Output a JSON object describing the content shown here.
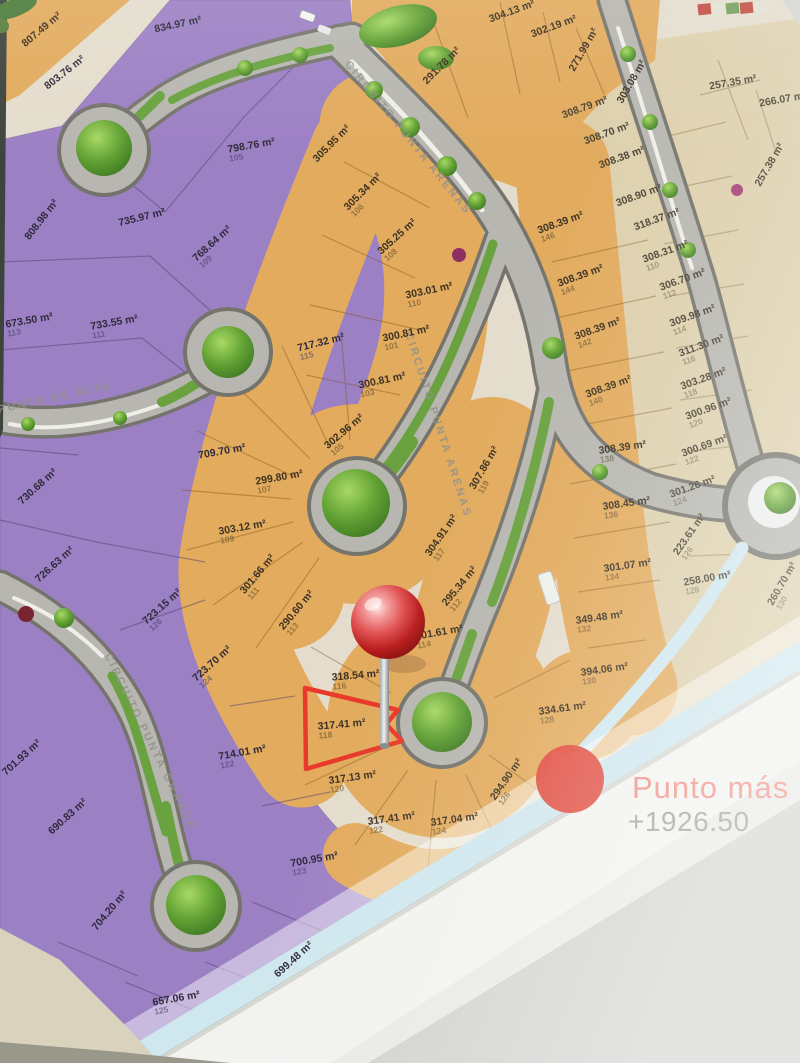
{
  "annotation": {
    "label_partial": "Punto más b",
    "elevation": "+1926.50"
  },
  "highlight": {
    "area": "317.41 m²",
    "lot": "118"
  },
  "colors": {
    "purple_zone": "#9c80c4",
    "orange_zone": "#e2ab5e",
    "beige_zone": "#ddd0ad",
    "road_fill": "#b7b6b0",
    "road_casing": "#75746c",
    "highlight_red": "#e8392a",
    "pin_red": "#c21f1f",
    "edge_blue": "#cfe7ee",
    "punto_text": "#ef8d82",
    "elevation_text": "#9fa09b",
    "tree_green": "#63a335"
  },
  "streets": [
    {
      "name": "CIRCUITO PUNTA ARENAS",
      "x": 408,
      "y": 138,
      "rot": 51
    },
    {
      "name": "CIRCUITO PUNTA ARENAS",
      "x": 438,
      "y": 425,
      "rot": 72
    },
    {
      "name": "PUNTA DE MITA",
      "x": 55,
      "y": 398,
      "rot": -12
    },
    {
      "name": "CIRCUITO PUNTA GRANDE",
      "x": 150,
      "y": 742,
      "rot": 64
    }
  ],
  "lots": [
    {
      "zone": "purple",
      "area": "834.97 m²",
      "lot": "",
      "x": 178,
      "y": 25,
      "rot": -12
    },
    {
      "zone": "purple",
      "area": "803.76 m²",
      "lot": "",
      "x": 65,
      "y": 73,
      "rot": -38
    },
    {
      "zone": "purple",
      "area": "798.76 m²",
      "lot": "105",
      "x": 252,
      "y": 150,
      "rot": -10
    },
    {
      "zone": "purple",
      "area": "808.98 m²",
      "lot": "",
      "x": 42,
      "y": 220,
      "rot": -52
    },
    {
      "zone": "purple",
      "area": "735.97 m²",
      "lot": "",
      "x": 142,
      "y": 218,
      "rot": -14
    },
    {
      "zone": "purple",
      "area": "768.64 m²",
      "lot": "109",
      "x": 215,
      "y": 247,
      "rot": -42
    },
    {
      "zone": "purple",
      "area": "733.55 m²",
      "lot": "111",
      "x": 115,
      "y": 327,
      "rot": -10
    },
    {
      "zone": "purple",
      "area": "673.50 m²",
      "lot": "113",
      "x": 30,
      "y": 325,
      "rot": -10
    },
    {
      "zone": "purple",
      "area": "717.32 m²",
      "lot": "115",
      "x": 322,
      "y": 347,
      "rot": -14
    },
    {
      "zone": "purple",
      "area": "709.70 m²",
      "lot": "",
      "x": 222,
      "y": 452,
      "rot": -10
    },
    {
      "zone": "purple",
      "area": "730.68 m²",
      "lot": "",
      "x": 38,
      "y": 487,
      "rot": -42
    },
    {
      "zone": "purple",
      "area": "726.63 m²",
      "lot": "",
      "x": 55,
      "y": 565,
      "rot": -42
    },
    {
      "zone": "purple",
      "area": "723.15 m²",
      "lot": "126",
      "x": 165,
      "y": 610,
      "rot": -42
    },
    {
      "zone": "purple",
      "area": "723.70 m²",
      "lot": "124",
      "x": 215,
      "y": 667,
      "rot": -42
    },
    {
      "zone": "purple",
      "area": "714.01 m²",
      "lot": "122",
      "x": 243,
      "y": 757,
      "rot": -10
    },
    {
      "zone": "purple",
      "area": "701.93 m²",
      "lot": "",
      "x": 22,
      "y": 758,
      "rot": -42
    },
    {
      "zone": "purple",
      "area": "690.83 m²",
      "lot": "",
      "x": 68,
      "y": 817,
      "rot": -42
    },
    {
      "zone": "purple",
      "area": "700.95 m²",
      "lot": "123",
      "x": 315,
      "y": 864,
      "rot": -10
    },
    {
      "zone": "purple",
      "area": "704.20 m²",
      "lot": "",
      "x": 110,
      "y": 911,
      "rot": -50
    },
    {
      "zone": "purple",
      "area": "699.48 m²",
      "lot": "",
      "x": 294,
      "y": 960,
      "rot": -42
    },
    {
      "zone": "purple",
      "area": "657.06 m²",
      "lot": "125",
      "x": 177,
      "y": 1003,
      "rot": -10
    },
    {
      "zone": "orange",
      "area": "807.49 m²",
      "lot": "",
      "x": 42,
      "y": 30,
      "rot": -40
    },
    {
      "zone": "orange",
      "area": "305.95 m²",
      "lot": "",
      "x": 332,
      "y": 144,
      "rot": -45
    },
    {
      "zone": "orange",
      "area": "291.78 m²",
      "lot": "",
      "x": 442,
      "y": 66,
      "rot": -45
    },
    {
      "zone": "orange",
      "area": "304.13 m²",
      "lot": "",
      "x": 512,
      "y": 12,
      "rot": -20
    },
    {
      "zone": "orange",
      "area": "302.19 m²",
      "lot": "",
      "x": 554,
      "y": 27,
      "rot": -20
    },
    {
      "zone": "orange",
      "area": "271.99 m²",
      "lot": "",
      "x": 584,
      "y": 50,
      "rot": -60
    },
    {
      "zone": "orange",
      "area": "303.08 m²",
      "lot": "",
      "x": 632,
      "y": 82,
      "rot": -60
    },
    {
      "zone": "orange",
      "area": "305.34 m²",
      "lot": "106",
      "x": 366,
      "y": 195,
      "rot": -45
    },
    {
      "zone": "orange",
      "area": "305.25 m²",
      "lot": "108",
      "x": 400,
      "y": 240,
      "rot": -42
    },
    {
      "zone": "orange",
      "area": "303.01 m²",
      "lot": "110",
      "x": 430,
      "y": 295,
      "rot": -12
    },
    {
      "zone": "orange",
      "area": "300.81 m²",
      "lot": "101",
      "x": 407,
      "y": 338,
      "rot": -12
    },
    {
      "zone": "orange",
      "area": "300.81 m²",
      "lot": "103",
      "x": 383,
      "y": 385,
      "rot": -12
    },
    {
      "zone": "orange",
      "area": "302.96 m²",
      "lot": "105",
      "x": 347,
      "y": 435,
      "rot": -40
    },
    {
      "zone": "orange",
      "area": "299.80 m²",
      "lot": "107",
      "x": 280,
      "y": 482,
      "rot": -10
    },
    {
      "zone": "orange",
      "area": "303.12 m²",
      "lot": "109",
      "x": 243,
      "y": 532,
      "rot": -10
    },
    {
      "zone": "orange",
      "area": "301.66 m²",
      "lot": "111",
      "x": 261,
      "y": 577,
      "rot": -50
    },
    {
      "zone": "orange",
      "area": "290.60 m²",
      "lot": "113",
      "x": 300,
      "y": 613,
      "rot": -50
    },
    {
      "zone": "orange",
      "area": "307.86 m²",
      "lot": "119",
      "x": 488,
      "y": 470,
      "rot": -60
    },
    {
      "zone": "orange",
      "area": "304.91 m²",
      "lot": "117",
      "x": 445,
      "y": 538,
      "rot": -55
    },
    {
      "zone": "orange",
      "area": "295.34 m²",
      "lot": "112",
      "x": 463,
      "y": 589,
      "rot": -50
    },
    {
      "zone": "orange",
      "area": "301.61 m²",
      "lot": "114",
      "x": 440,
      "y": 637,
      "rot": -10
    },
    {
      "zone": "orange",
      "area": "318.54 m²",
      "lot": "116",
      "x": 356,
      "y": 680,
      "rot": -5
    },
    {
      "zone": "orange",
      "area": "317.41 m²",
      "lot": "118",
      "x": 342,
      "y": 729,
      "rot": -5,
      "hl": true
    },
    {
      "zone": "orange",
      "area": "317.13 m²",
      "lot": "120",
      "x": 353,
      "y": 782,
      "rot": -8
    },
    {
      "zone": "orange",
      "area": "317.41 m²",
      "lot": "122",
      "x": 392,
      "y": 823,
      "rot": -8
    },
    {
      "zone": "orange",
      "area": "317.04 m²",
      "lot": "124",
      "x": 455,
      "y": 824,
      "rot": -8
    },
    {
      "zone": "orange",
      "area": "294.90 m²",
      "lot": "126",
      "x": 510,
      "y": 782,
      "rot": -55
    },
    {
      "zone": "orange",
      "area": "334.61 m²",
      "lot": "128",
      "x": 563,
      "y": 713,
      "rot": -8
    },
    {
      "zone": "orange",
      "area": "394.06 m²",
      "lot": "130",
      "x": 605,
      "y": 674,
      "rot": -8
    },
    {
      "zone": "orange",
      "area": "349.48 m²",
      "lot": "132",
      "x": 600,
      "y": 622,
      "rot": -8
    },
    {
      "zone": "orange",
      "area": "301.07 m²",
      "lot": "134",
      "x": 628,
      "y": 570,
      "rot": -8
    },
    {
      "zone": "orange",
      "area": "308.45 m²",
      "lot": "136",
      "x": 627,
      "y": 508,
      "rot": -8
    },
    {
      "zone": "orange",
      "area": "308.39 m²",
      "lot": "138",
      "x": 623,
      "y": 452,
      "rot": -8
    },
    {
      "zone": "orange",
      "area": "308.39 m²",
      "lot": "140",
      "x": 610,
      "y": 391,
      "rot": -20
    },
    {
      "zone": "orange",
      "area": "308.39 m²",
      "lot": "142",
      "x": 599,
      "y": 333,
      "rot": -20
    },
    {
      "zone": "orange",
      "area": "308.39 m²",
      "lot": "144",
      "x": 582,
      "y": 280,
      "rot": -20
    },
    {
      "zone": "orange",
      "area": "308.39 m²",
      "lot": "146",
      "x": 562,
      "y": 227,
      "rot": -20
    },
    {
      "zone": "beige",
      "area": "257.35 m²",
      "lot": "",
      "x": 733,
      "y": 83,
      "rot": -10
    },
    {
      "zone": "beige",
      "area": "266.07 m²",
      "lot": "",
      "x": 783,
      "y": 100,
      "rot": -10
    },
    {
      "zone": "beige",
      "area": "257.38 m²",
      "lot": "",
      "x": 770,
      "y": 165,
      "rot": -60
    },
    {
      "zone": "beige",
      "area": "308.79 m²",
      "lot": "",
      "x": 585,
      "y": 108,
      "rot": -20
    },
    {
      "zone": "beige",
      "area": "308.70 m²",
      "lot": "",
      "x": 607,
      "y": 134,
      "rot": -20
    },
    {
      "zone": "beige",
      "area": "308.38 m²",
      "lot": "",
      "x": 622,
      "y": 158,
      "rot": -20
    },
    {
      "zone": "beige",
      "area": "308.90 m²",
      "lot": "",
      "x": 639,
      "y": 196,
      "rot": -20
    },
    {
      "zone": "beige",
      "area": "318.37 m²",
      "lot": "",
      "x": 657,
      "y": 220,
      "rot": -20
    },
    {
      "zone": "beige",
      "area": "308.31 m²",
      "lot": "110",
      "x": 667,
      "y": 256,
      "rot": -20
    },
    {
      "zone": "beige",
      "area": "306.70 m²",
      "lot": "112",
      "x": 684,
      "y": 284,
      "rot": -20
    },
    {
      "zone": "beige",
      "area": "309.98 m²",
      "lot": "114",
      "x": 694,
      "y": 320,
      "rot": -20
    },
    {
      "zone": "beige",
      "area": "311.30 m²",
      "lot": "116",
      "x": 703,
      "y": 350,
      "rot": -20
    },
    {
      "zone": "beige",
      "area": "303.28 m²",
      "lot": "118",
      "x": 705,
      "y": 383,
      "rot": -20
    },
    {
      "zone": "beige",
      "area": "300.96 m²",
      "lot": "120",
      "x": 710,
      "y": 413,
      "rot": -20
    },
    {
      "zone": "beige",
      "area": "300.69 m²",
      "lot": "122",
      "x": 706,
      "y": 450,
      "rot": -20
    },
    {
      "zone": "beige",
      "area": "301.26 m²",
      "lot": "124",
      "x": 694,
      "y": 491,
      "rot": -20
    },
    {
      "zone": "beige",
      "area": "223.61 m²",
      "lot": "126",
      "x": 693,
      "y": 537,
      "rot": -55
    },
    {
      "zone": "beige",
      "area": "258.00 m²",
      "lot": "128",
      "x": 708,
      "y": 583,
      "rot": -10
    },
    {
      "zone": "beige",
      "area": "260.70 m²",
      "lot": "130",
      "x": 786,
      "y": 586,
      "rot": -60
    }
  ]
}
